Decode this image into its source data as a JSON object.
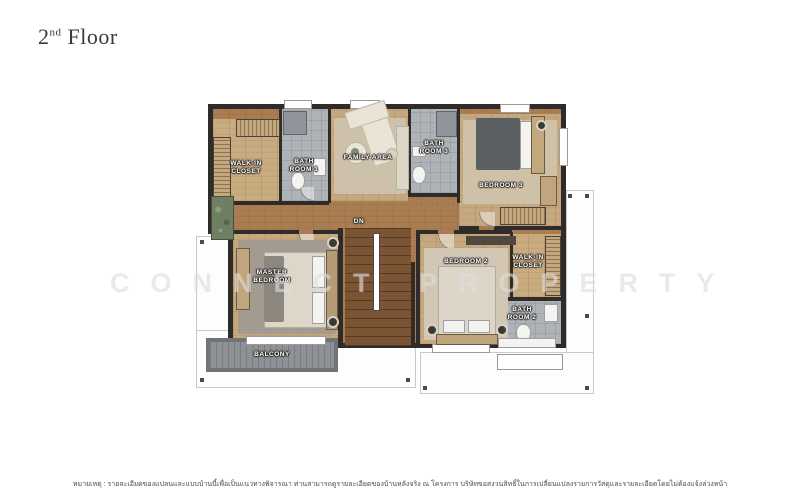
{
  "page": {
    "title": {
      "number": "2",
      "ordinal": "nd",
      "word": "Floor"
    }
  },
  "watermark": {
    "text": "CONNECT PROPERTY"
  },
  "rooms": {
    "walk_in_closet_1": "WALK-IN\nCLOSET",
    "bath_room_1": "BATH\nROOM 1",
    "family_area": "FAMILY AREA",
    "bath_room_3": "BATH\nROOM 3",
    "bedroom_3": "BEDROOM 3",
    "master_bedroom": "MASTER\nBEDROOM",
    "bedroom_2": "BEDROOM 2",
    "walk_in_closet_2": "WALK-IN\nCLOSET",
    "bath_room_2": "BATH\nROOM 2",
    "balcony": "BALCONY",
    "stairs_down": "DN"
  },
  "disclaimer": "หมายเหตุ : รายละเอียดของแปลนและแบบบ้านนี้เพื่อเป็นแนวทางพิจารณา ท่านสามารถดูรายละเอียดของบ้านหลังจริง ณ โครงการ บริษัทขอสงวนสิทธิ์ในการเปลี่ยนแปลงรายการวัสดุและรายละเอียดโดยไม่ต้องแจ้งล่วงหน้า",
  "colors": {
    "wall": "#2e2b28",
    "corridor_wood": "#a97c52",
    "room_wood": "#c6a87e",
    "bathroom_tile": "#adb3b6",
    "balcony_deck": "#8e9296",
    "stairs_wood": "#7b5434",
    "band_outline": "#c9c9c9",
    "label_text": "#ffffff",
    "title_text": "#3a3a3a"
  }
}
